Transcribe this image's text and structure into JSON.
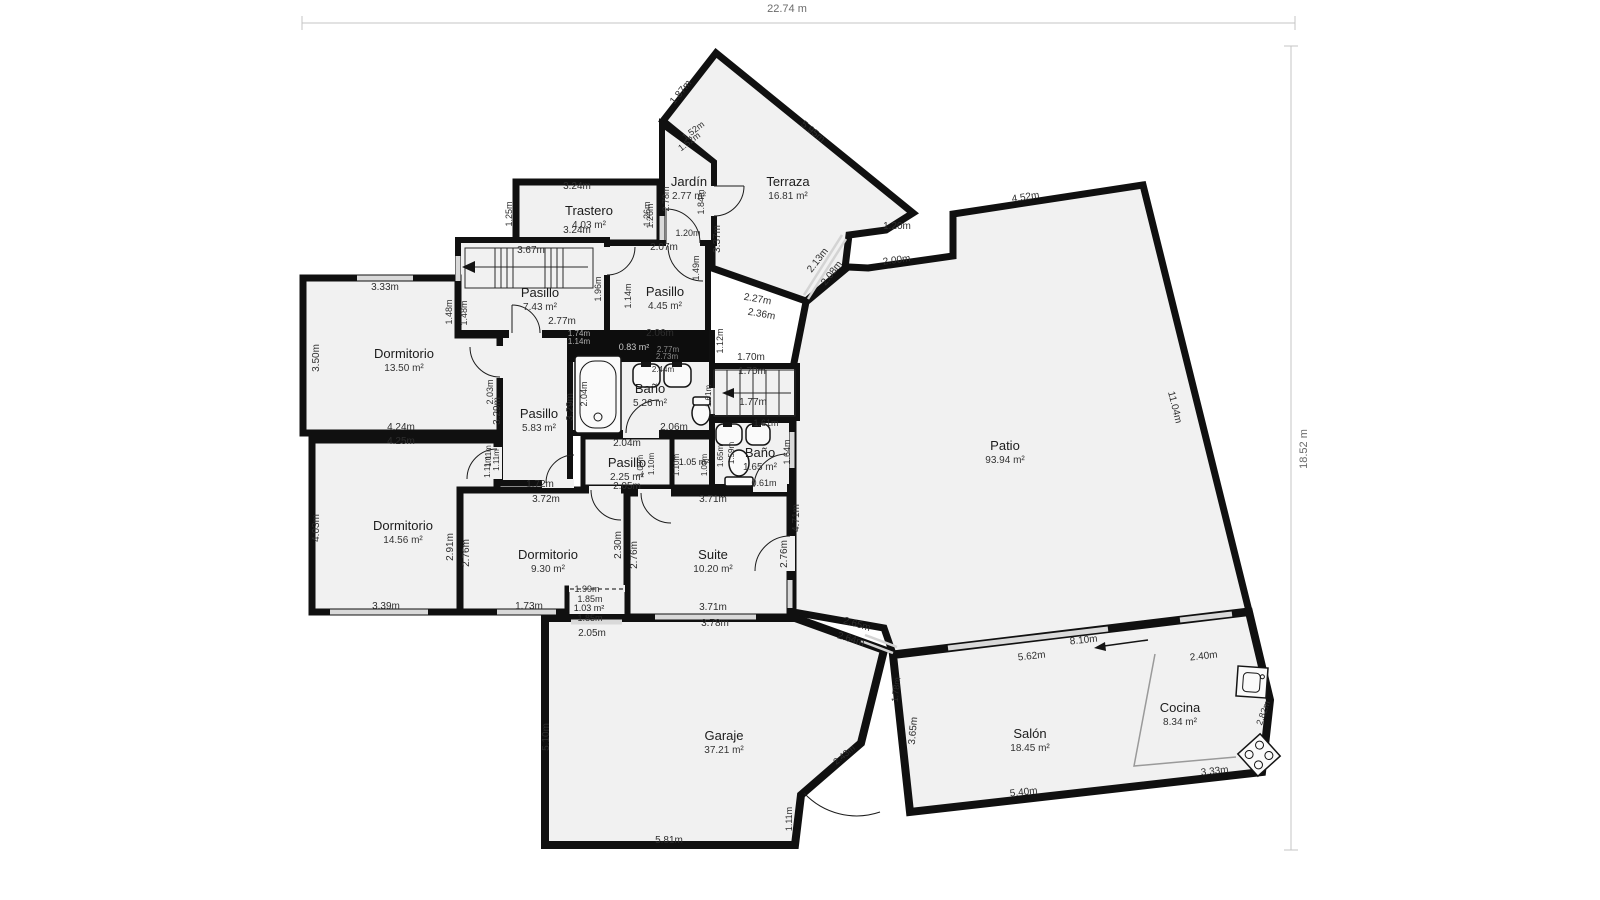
{
  "plan": {
    "type": "floor-plan",
    "overall": {
      "width_label": "22.74 m",
      "height_label": "18.52 m"
    },
    "colors": {
      "wall": "#101010",
      "room_fill": "#f1f1f1",
      "outside": "#ffffff",
      "dark_area_fill": "#0d0d0d",
      "dim_text": "#2e2e2e",
      "muted_dim_text": "#a8a8a8",
      "window": "#d9d9d9",
      "dim_line": "#c4c4c4"
    },
    "icons": {
      "bathtub-icon": "rounded-rect tub with drain circle",
      "sink-icon": "rounded basin with tap mark",
      "toilet-icon": "oval bowl with cistern",
      "kitchen-sink-icon": "square counter basin",
      "stove-icon": "rotated square with four burner circles",
      "stairs-direction-arrow-icon": "left pointing arrow",
      "north-entry-arrow-icon": "left pointing arrow"
    },
    "rooms": [
      {
        "id": "terraza",
        "name": "Terraza",
        "area": "16.81 m²",
        "x": 788,
        "y": 186
      },
      {
        "id": "jardin",
        "name": "Jardín",
        "area": "2.77 m²",
        "x": 689,
        "y": 186
      },
      {
        "id": "trastero",
        "name": "Trastero",
        "area": "4.03 m²",
        "x": 589,
        "y": 215
      },
      {
        "id": "pasillo-escalera",
        "name": "Pasillo",
        "area": "7.43 m²",
        "x": 540,
        "y": 297
      },
      {
        "id": "pasillo-norte",
        "name": "Pasillo",
        "area": "4.45 m²",
        "x": 665,
        "y": 296
      },
      {
        "id": "dormitorio-1",
        "name": "Dormitorio",
        "area": "13.50 m²",
        "x": 404,
        "y": 358
      },
      {
        "id": "pasillo-central",
        "name": "Pasillo",
        "area": "5.83 m²",
        "x": 539,
        "y": 418
      },
      {
        "id": "bano-principal",
        "name": "Baño",
        "area": "5.26 m²",
        "x": 650,
        "y": 393
      },
      {
        "id": "armario-oscuro",
        "name": "",
        "area": "0.83 m²",
        "x": 634,
        "y": 350,
        "c": "#c9c9c9",
        "s": 9
      },
      {
        "id": "pasillo-sur",
        "name": "Pasillo",
        "area": "2.25 m²",
        "x": 627,
        "y": 467
      },
      {
        "id": "armario",
        "name": "",
        "area": "1.05 m²",
        "x": 694,
        "y": 465,
        "s": 9
      },
      {
        "id": "bano-pequeno",
        "name": "Baño",
        "area": "1.65 m²",
        "x": 760,
        "y": 457
      },
      {
        "id": "dormitorio-2",
        "name": "Dormitorio",
        "area": "14.56 m²",
        "x": 403,
        "y": 530
      },
      {
        "id": "dormitorio-3",
        "name": "Dormitorio",
        "area": "9.30 m²",
        "x": 548,
        "y": 559
      },
      {
        "id": "suite",
        "name": "Suite",
        "area": "10.20 m²",
        "x": 713,
        "y": 559
      },
      {
        "id": "armario-2",
        "name": "",
        "area": "1.03 m²",
        "x": 589,
        "y": 611,
        "s": 9
      },
      {
        "id": "patio",
        "name": "Patio",
        "area": "93.94 m²",
        "x": 1005,
        "y": 450
      },
      {
        "id": "garaje",
        "name": "Garaje",
        "area": "37.21 m²",
        "x": 724,
        "y": 740
      },
      {
        "id": "salon",
        "name": "Salón",
        "area": "18.45 m²",
        "x": 1030,
        "y": 738
      },
      {
        "id": "cocina",
        "name": "Cocina",
        "area": "8.34 m²",
        "x": 1180,
        "y": 712
      }
    ],
    "dimensions": [
      {
        "t": "1.87m",
        "x": 683,
        "y": 94,
        "r": -51
      },
      {
        "t": "5.95m",
        "x": 811,
        "y": 134,
        "r": 39
      },
      {
        "t": "1.52m",
        "x": 695,
        "y": 133,
        "r": -37,
        "s": 9
      },
      {
        "t": "1.52m",
        "x": 691,
        "y": 144,
        "r": -37,
        "s": 9
      },
      {
        "t": "2.78m",
        "x": 669,
        "y": 199,
        "r": -90,
        "s": 9
      },
      {
        "t": "1.26m",
        "x": 653,
        "y": 216,
        "r": -90,
        "s": 9
      },
      {
        "t": "1.84m",
        "x": 704,
        "y": 202,
        "r": -90,
        "s": 9
      },
      {
        "t": "3.37m",
        "x": 720,
        "y": 239,
        "r": -90
      },
      {
        "t": "1.20m",
        "x": 688,
        "y": 236,
        "s": 9
      },
      {
        "t": "2.07m",
        "x": 664,
        "y": 250
      },
      {
        "t": "1.20m",
        "x": 897,
        "y": 229
      },
      {
        "t": "2.13m",
        "x": 820,
        "y": 262,
        "r": -52
      },
      {
        "t": "2.08m",
        "x": 834,
        "y": 275,
        "r": -52
      },
      {
        "t": "2.00m",
        "x": 897,
        "y": 263,
        "r": -8
      },
      {
        "t": "2.27m",
        "x": 757,
        "y": 302,
        "r": 10
      },
      {
        "t": "2.36m",
        "x": 761,
        "y": 317,
        "r": 10
      },
      {
        "t": "4.52m",
        "x": 1026,
        "y": 200,
        "r": -9
      },
      {
        "t": "11.04m",
        "x": 1172,
        "y": 408,
        "r": 76
      },
      {
        "t": "3.24m",
        "x": 577,
        "y": 189
      },
      {
        "t": "3.24m",
        "x": 577,
        "y": 233
      },
      {
        "t": "1.25m",
        "x": 512,
        "y": 214,
        "r": -90,
        "s": 9
      },
      {
        "t": "1.26m",
        "x": 650,
        "y": 214,
        "r": -90,
        "s": 9
      },
      {
        "t": "3.67m",
        "x": 531,
        "y": 253
      },
      {
        "t": "1.48m",
        "x": 452,
        "y": 312,
        "r": -90,
        "s": 9
      },
      {
        "t": "1.48m",
        "x": 467,
        "y": 313,
        "r": -90,
        "s": 9
      },
      {
        "t": "2.77m",
        "x": 562,
        "y": 324
      },
      {
        "t": "1.96m",
        "x": 601,
        "y": 289,
        "r": -90,
        "s": 9
      },
      {
        "t": "1.74m",
        "x": 579,
        "y": 336,
        "c": "#b0b0b0",
        "s": 8
      },
      {
        "t": "1.14m",
        "x": 579,
        "y": 344,
        "c": "#b0b0b0",
        "s": 8
      },
      {
        "t": "1.49m",
        "x": 699,
        "y": 268,
        "r": -90,
        "s": 9
      },
      {
        "t": "1.14m",
        "x": 631,
        "y": 296,
        "r": -90,
        "s": 9
      },
      {
        "t": "1.12m",
        "x": 723,
        "y": 341,
        "r": -90,
        "s": 9
      },
      {
        "t": "2.06m",
        "x": 660,
        "y": 336
      },
      {
        "t": "2.77m",
        "x": 668,
        "y": 352,
        "c": "#8a8a8a",
        "s": 8
      },
      {
        "t": "2.73m",
        "x": 667,
        "y": 359,
        "c": "#8a8a8a",
        "s": 8
      },
      {
        "t": "2.44m",
        "x": 663,
        "y": 372,
        "s": 8
      },
      {
        "t": "2.04m",
        "x": 587,
        "y": 394,
        "r": -90,
        "s": 9
      },
      {
        "t": "2.06m",
        "x": 674,
        "y": 430
      },
      {
        "t": "1.61m",
        "x": 711,
        "y": 396,
        "r": -90,
        "s": 8
      },
      {
        "t": "1.70m",
        "x": 751,
        "y": 360
      },
      {
        "t": "1.70m",
        "x": 752,
        "y": 374
      },
      {
        "t": "1.77m",
        "x": 753,
        "y": 405
      },
      {
        "t": "1.61m",
        "x": 766,
        "y": 426,
        "s": 9
      },
      {
        "t": "1.59m",
        "x": 734,
        "y": 453,
        "r": -90,
        "s": 8
      },
      {
        "t": "1.64m",
        "x": 790,
        "y": 452,
        "r": -90,
        "s": 9
      },
      {
        "t": "0.61m",
        "x": 764,
        "y": 486,
        "s": 9
      },
      {
        "t": "2.04m",
        "x": 627,
        "y": 446
      },
      {
        "t": "1.10m",
        "x": 654,
        "y": 464,
        "r": -90,
        "s": 8
      },
      {
        "t": "1.09m",
        "x": 643,
        "y": 466,
        "r": -90,
        "s": 8
      },
      {
        "t": "1.10m",
        "x": 679,
        "y": 465,
        "r": -90,
        "s": 8
      },
      {
        "t": "1.09m",
        "x": 707,
        "y": 465,
        "r": -90,
        "s": 8
      },
      {
        "t": "1.65m",
        "x": 723,
        "y": 456,
        "r": -90,
        "s": 8
      },
      {
        "t": "2.05m",
        "x": 627,
        "y": 489
      },
      {
        "t": "3.29m",
        "x": 500,
        "y": 411,
        "r": -90
      },
      {
        "t": "3.29m",
        "x": 573,
        "y": 407,
        "r": -90
      },
      {
        "t": "1.72m",
        "x": 540,
        "y": 487
      },
      {
        "t": "1.11m",
        "x": 491,
        "y": 456,
        "r": -90,
        "s": 8
      },
      {
        "t": "1.11m",
        "x": 499,
        "y": 460,
        "r": -90,
        "s": 8
      },
      {
        "t": "3.33m",
        "x": 385,
        "y": 290
      },
      {
        "t": "3.50m",
        "x": 319,
        "y": 358,
        "r": -90
      },
      {
        "t": "4.24m",
        "x": 401,
        "y": 430
      },
      {
        "t": "4.25m",
        "x": 401,
        "y": 444
      },
      {
        "t": "2.03m",
        "x": 493,
        "y": 392,
        "r": -90,
        "s": 9
      },
      {
        "t": "4.03m",
        "x": 319,
        "y": 528,
        "r": -90
      },
      {
        "t": "3.39m",
        "x": 386,
        "y": 609
      },
      {
        "t": "2.91m",
        "x": 453,
        "y": 547,
        "r": -90
      },
      {
        "t": "2.76m",
        "x": 469,
        "y": 553,
        "r": -90
      },
      {
        "t": "1.11m",
        "x": 490,
        "y": 467,
        "r": -90,
        "s": 8
      },
      {
        "t": "3.72m",
        "x": 546,
        "y": 502
      },
      {
        "t": "2.30m",
        "x": 621,
        "y": 545,
        "r": -90
      },
      {
        "t": "2.76m",
        "x": 637,
        "y": 555,
        "r": -90
      },
      {
        "t": "1.73m",
        "x": 529,
        "y": 609
      },
      {
        "t": "1.99m",
        "x": 587,
        "y": 592,
        "s": 9
      },
      {
        "t": "1.85m",
        "x": 590,
        "y": 602,
        "s": 9
      },
      {
        "t": "1.85m",
        "x": 590,
        "y": 621,
        "s": 9
      },
      {
        "t": "2.05m",
        "x": 592,
        "y": 636
      },
      {
        "t": "3.71m",
        "x": 713,
        "y": 502
      },
      {
        "t": "3.71m",
        "x": 713,
        "y": 610
      },
      {
        "t": "3.78m",
        "x": 715,
        "y": 626
      },
      {
        "t": "2.76m",
        "x": 787,
        "y": 554,
        "r": -90
      },
      {
        "t": "4.71m",
        "x": 799,
        "y": 518,
        "r": -90
      },
      {
        "t": "5.10m",
        "x": 549,
        "y": 737,
        "r": -90
      },
      {
        "t": "5.81m",
        "x": 669,
        "y": 843
      },
      {
        "t": "1.11m",
        "x": 792,
        "y": 819,
        "r": -90,
        "s": 9
      },
      {
        "t": "2.43m",
        "x": 846,
        "y": 757,
        "r": -40,
        "s": 9
      },
      {
        "t": "2.65m",
        "x": 856,
        "y": 627,
        "r": 17
      },
      {
        "t": "2.64m",
        "x": 850,
        "y": 642,
        "r": 17
      },
      {
        "t": "1.78m",
        "x": 899,
        "y": 690,
        "r": -83,
        "s": 9
      },
      {
        "t": "3.65m",
        "x": 916,
        "y": 731,
        "r": -85
      },
      {
        "t": "8.10m",
        "x": 1084,
        "y": 643,
        "r": -6
      },
      {
        "t": "5.62m",
        "x": 1032,
        "y": 659,
        "r": -6
      },
      {
        "t": "2.40m",
        "x": 1204,
        "y": 659,
        "r": -6
      },
      {
        "t": "5.40m",
        "x": 1024,
        "y": 795,
        "r": -6
      },
      {
        "t": "3.33m",
        "x": 1215,
        "y": 774,
        "r": -6
      },
      {
        "t": "2.82m",
        "x": 1266,
        "y": 714,
        "r": -70,
        "s": 9
      }
    ]
  }
}
